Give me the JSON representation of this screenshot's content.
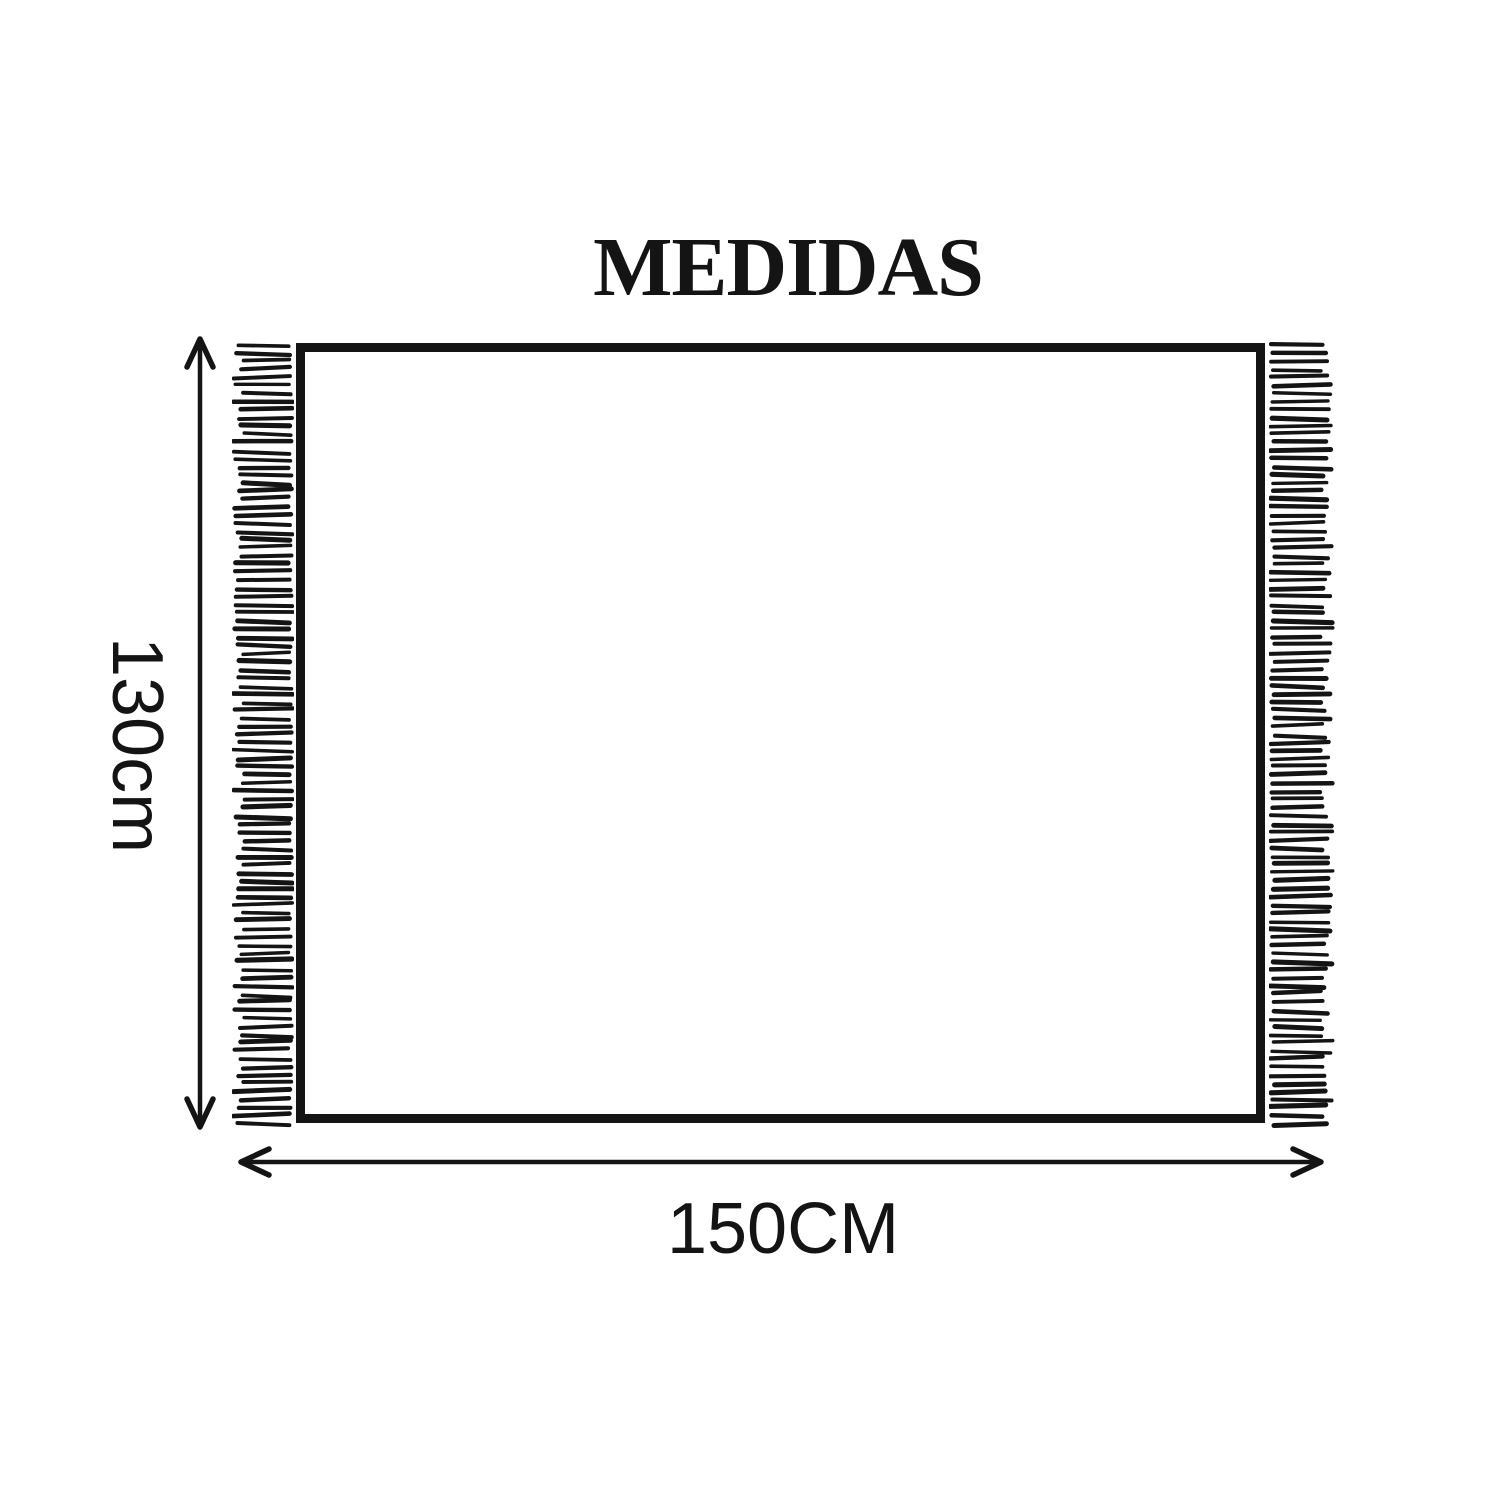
{
  "title": "MEDIDAS",
  "dimensions": {
    "height": {
      "label": "130cm"
    },
    "width": {
      "label": "150CM"
    }
  },
  "icons": {
    "vertical_arrow": "double-headed-vertical-arrow",
    "horizontal_arrow": "double-headed-horizontal-arrow",
    "left_fringe": "fringe-tassels-left",
    "right_fringe": "fringe-tassels-right"
  },
  "colors": {
    "ink": "#141414",
    "background": "#ffffff"
  }
}
